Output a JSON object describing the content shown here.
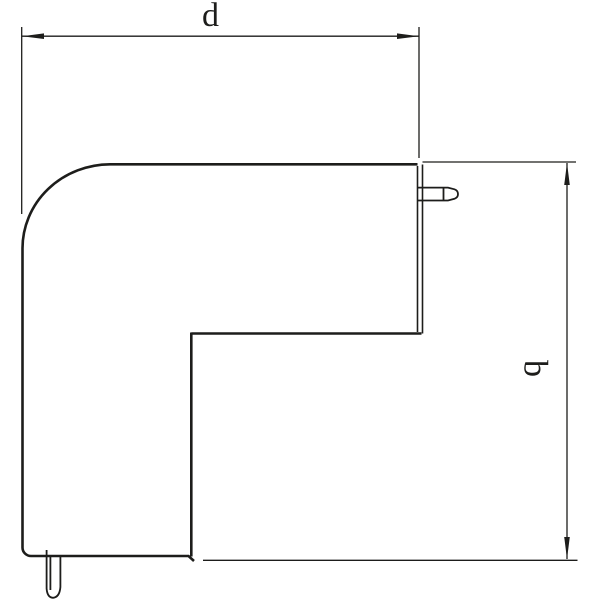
{
  "drawing": {
    "top_dimension": {
      "label": "d"
    },
    "right_dimension": {
      "label": "b"
    }
  },
  "colors": {
    "line": "#1d1d1b",
    "background": "#ffffff"
  }
}
